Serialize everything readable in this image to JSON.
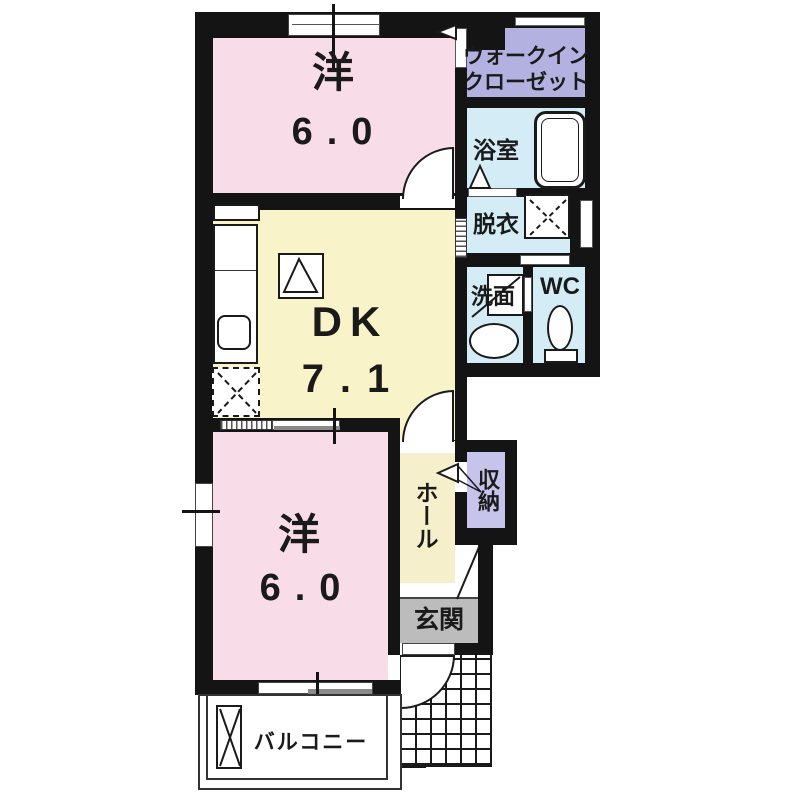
{
  "rooms": {
    "western_top": {
      "label": "洋",
      "area": "6.0"
    },
    "walk_in_closet": {
      "line1": "ウォークイン",
      "line2": "クローゼット"
    },
    "bathroom": {
      "label": "浴室"
    },
    "dressing_room": {
      "label": "脱衣"
    },
    "washroom": {
      "label": "洗面"
    },
    "wc": {
      "label": "WC"
    },
    "dining_kitchen": {
      "label": "DK",
      "area": "7.1"
    },
    "western_bottom": {
      "label": "洋",
      "area": "6.0"
    },
    "hall": {
      "label": "ホール"
    },
    "storage": {
      "label": "収納"
    },
    "entrance": {
      "label": "玄関"
    },
    "balcony": {
      "label": "バルコニー"
    }
  },
  "colors": {
    "wall": "#141414",
    "western_room": "#f8dce7",
    "dk": "#f9f3c9",
    "hall": "#f6efcb",
    "closet": "#b3b1df",
    "storage": "#c6c4eb",
    "wet_area": "#d3ecf5",
    "entrance_floor": "#bcbcbc"
  }
}
